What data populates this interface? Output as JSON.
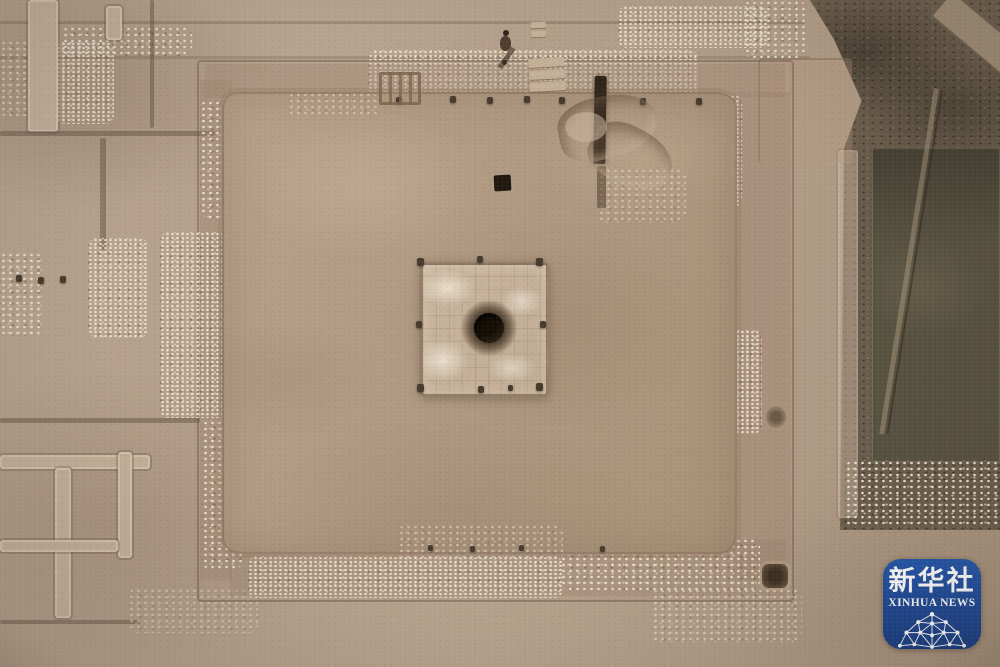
{
  "scene": {
    "type": "aerial photograph",
    "subject": "Drone view of an archaeological excavation: large square rammed-earth platform with a central square pit containing a round well shaft, surrounded by excavation trenches, rubble scatters and a dark unexcavated scrub strip on the right",
    "features": {
      "platform": "rammed-earth platform foundation",
      "central_pit": "central square pit with plaster patches",
      "well": "dark circular well shaft",
      "trenches": "excavation trench grid",
      "rubble": "stone rubble scatter",
      "scrub": "unexcavated scrub ground",
      "person": "surveyor standing at top edge"
    },
    "palette": {
      "ground": "#b3a08b",
      "ground_dark": "#a08a75",
      "platform": "#b29b84",
      "pit_floor": "#c6b29a",
      "well_hole": "#1c1309",
      "rubble_light": "#e6dcc6",
      "scrub_strip": "#665a49",
      "dark_field": "#575140",
      "badge_blue": "#1c4794",
      "badge_text": "#ffffff"
    }
  },
  "watermark": {
    "cn": "新华社",
    "en": "XINHUA NEWS",
    "icon": "network-dome-icon"
  }
}
